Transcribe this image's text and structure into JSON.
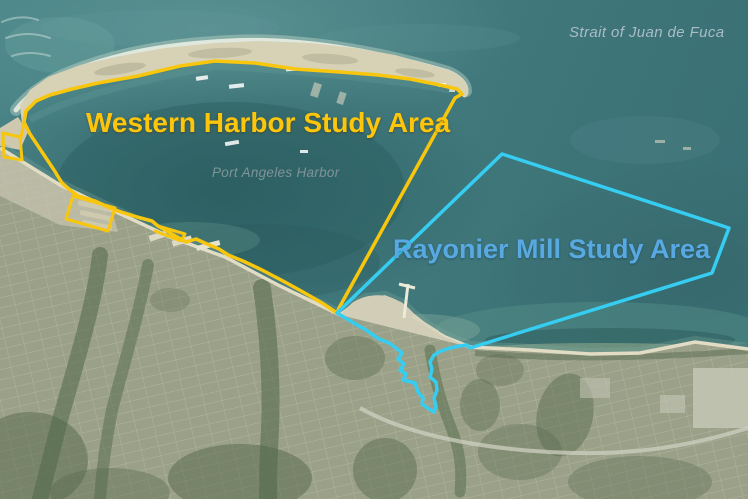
{
  "labels": {
    "strait": "Strait of Juan de Fuca",
    "harbor": "Port Angeles Harbor",
    "western_area": "Western Harbor Study Area",
    "rayonier_area": "Rayonier Mill Study Area"
  },
  "colors": {
    "western_outline": "#f8c60d",
    "western_label_text": "#fdc60b",
    "rayonier_outline": "#35cdf1",
    "rayonier_label_text": "#58a9e2",
    "strait_label_text": "#aabcc4",
    "harbor_label_text": "#7e9498"
  }
}
